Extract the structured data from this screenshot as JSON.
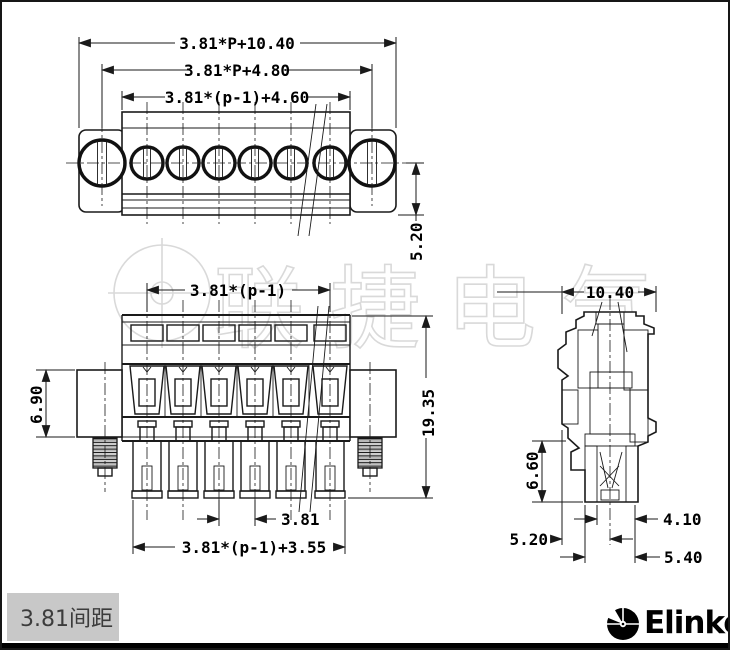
{
  "drawing": {
    "watermark": "联捷电气",
    "title_block_label": "3.81间距",
    "brand": "Elinker",
    "line_color": "#1a1a1a",
    "watermark_color": "#d9d9d9",
    "label_box_color": "#c8c8c8",
    "top_view": {
      "dim_overall_width": "3.81*P+10.40",
      "dim_mounting_centers": "3.81*P+4.80",
      "dim_housing_width": "3.81*(p-1)+4.60",
      "dim_depth": "5.20"
    },
    "front_view": {
      "dim_pole_span": "3.81*(p-1)",
      "dim_flange_height": "6.90",
      "dim_total_height": "19.35",
      "dim_pitch": "3.81",
      "dim_bottom_width": "3.81*(p-1)+3.55"
    },
    "side_view": {
      "dim_width": "10.40",
      "dim_lower_height": "6.60",
      "dim_foot_a": "4.10",
      "dim_foot_b": "5.20",
      "dim_foot_c": "5.40"
    }
  }
}
